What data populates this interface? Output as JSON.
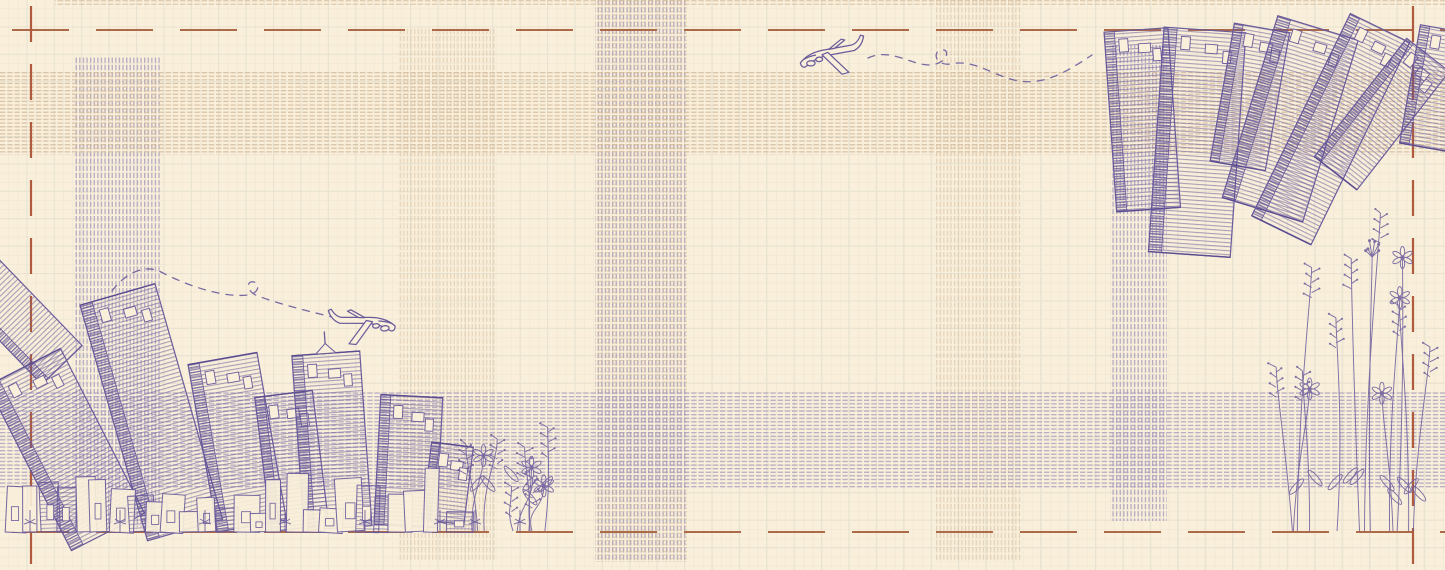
{
  "scene": {
    "title": "blueprint-plaid-city-wallpaper",
    "description": "Hand-sketched purple-ink city skylines and wildflowers on cream graph paper with woven plaid hatch bands, terracotta dashed register lines and airplane doodles with dashed looping flight trails.",
    "canvas": {
      "width": 1445,
      "height": 570
    },
    "palette": {
      "paper": "#f9efda",
      "subgrid": "#f2e9d7",
      "grid": "#e7e2d1",
      "tan_stripe": "#d6bd9e",
      "purple_stripe": "#a79bbd",
      "ink": "#6a5b9b",
      "ink_dense": "#5a4c90",
      "border_h": "#ac6a48",
      "border_v": "#b15b3e"
    },
    "grid": {
      "cell": 27.4,
      "subcell": 9.14
    }
  },
  "borders": {
    "horizontal_dashed": [
      {
        "y": 30,
        "x1": 0,
        "x2": 1445,
        "dash": "57 27",
        "width": 2
      },
      {
        "y": 532,
        "x1": 0,
        "x2": 1445,
        "dash": "57 27",
        "width": 2
      }
    ],
    "vertical_dashed": [
      {
        "x": 31,
        "y1": 0,
        "y2": 570,
        "dash": "36 22",
        "width": 2.2
      },
      {
        "x": 1413,
        "y1": 0,
        "y2": 570,
        "dash": "36 22",
        "width": 2.2
      }
    ]
  },
  "bands": {
    "vertical": [
      {
        "x": 75,
        "w": 85,
        "y1": 57,
        "y2": 527,
        "kind": "purple",
        "opacity": 0.8
      },
      {
        "x": 398,
        "w": 99,
        "y1": 28,
        "y2": 560,
        "kind": "tan",
        "opacity": 0.5
      },
      {
        "x": 595,
        "w": 92,
        "y1": 0,
        "y2": 562,
        "kind": "purple",
        "opacity": 0.85,
        "extra": "tan"
      },
      {
        "x": 935,
        "w": 87,
        "y1": 0,
        "y2": 562,
        "kind": "tan",
        "opacity": 0.55
      },
      {
        "x": 1110,
        "w": 57,
        "y1": 45,
        "y2": 521,
        "kind": "purple",
        "opacity": 0.8
      }
    ],
    "horizontal": [
      {
        "y": 0,
        "h": 7,
        "x1": 55,
        "x2": 1445,
        "kind": "tan",
        "opacity": 0.7
      },
      {
        "y": 70,
        "h": 85,
        "x1": 0,
        "x2": 1445,
        "kind": "tan",
        "opacity": 0.85
      },
      {
        "y": 392,
        "h": 96,
        "x1": 0,
        "x2": 1445,
        "kind": "purple",
        "opacity": 0.78
      }
    ]
  },
  "cities": {
    "bottom_left": {
      "name": "upright skyline fanning outward, base on lower dashed line",
      "ground_y": 532,
      "buildings": [
        {
          "cx": 62,
          "base": 365,
          "w": 56,
          "h": 135,
          "tilt": -44,
          "fragment": true
        },
        {
          "cx": 108,
          "base": 532,
          "w": 82,
          "h": 185,
          "tilt": -27
        },
        {
          "cx": 185,
          "base": 530,
          "w": 78,
          "h": 245,
          "tilt": -16
        },
        {
          "cx": 252,
          "base": 526,
          "w": 70,
          "h": 170,
          "tilt": -10
        },
        {
          "cx": 300,
          "base": 528,
          "w": 58,
          "h": 135,
          "tilt": -7
        },
        {
          "cx": 338,
          "base": 528,
          "w": 68,
          "h": 175,
          "tilt": -4,
          "spire": true
        },
        {
          "cx": 405,
          "base": 526,
          "w": 62,
          "h": 130,
          "tilt": 3
        },
        {
          "cx": 443,
          "base": 522,
          "w": 42,
          "h": 78,
          "tilt": 7
        }
      ],
      "base_strip": {
        "x1": 2,
        "x2": 458,
        "seed": 11,
        "count": 26
      },
      "trees_x": [
        30,
        120,
        205,
        285,
        365,
        440,
        475,
        520
      ]
    },
    "top_right": {
      "name": "inverted skyline hanging from upper dashed line",
      "ceiling_y": 30,
      "buildings": [
        {
          "cx": 1136,
          "top": 30,
          "w": 64,
          "h": 180,
          "tilt": -4
        },
        {
          "cx": 1205,
          "top": 30,
          "w": 82,
          "h": 225,
          "tilt": 4
        },
        {
          "cx": 1262,
          "top": 28,
          "w": 56,
          "h": 140,
          "tilt": 10
        },
        {
          "cx": 1318,
          "top": 28,
          "w": 84,
          "h": 190,
          "tilt": 17
        },
        {
          "cx": 1380,
          "top": 28,
          "w": 66,
          "h": 225,
          "tilt": 26
        },
        {
          "cx": 1428,
          "top": 55,
          "w": 54,
          "h": 150,
          "tilt": 38
        },
        {
          "cx": 1450,
          "top": 30,
          "w": 60,
          "h": 120,
          "tilt": 10
        }
      ]
    }
  },
  "planes": [
    {
      "name": "jet flying left, upper right area",
      "x": 797,
      "y": 37,
      "facing": "left",
      "rotate": -3,
      "trail": "M868,58 C893,46 916,70 936,64 C948,61 950,48 941,50 C932,52 936,66 950,64 C974,59 990,74 1014,80 C1043,87 1066,72 1092,55"
    },
    {
      "name": "jet flying right, above bottom-left skyline",
      "x": 394,
      "y": 300,
      "facing": "right",
      "rotate": -7,
      "trail": "M112,291 C126,272 146,264 161,272 C186,285 222,298 248,295 C258,294 261,284 254,282 C246,280 246,292 258,296 C282,305 312,312 332,317"
    }
  ],
  "flowers": [
    {
      "name": "tall wildflower border, right edge",
      "x0": 1292,
      "base_y": 531,
      "w": 122,
      "h": 325,
      "n": 13,
      "seed": 7
    },
    {
      "name": "grass and flower tuft, right of skyline",
      "x0": 428,
      "base_y": 531,
      "w": 118,
      "h": 105,
      "n": 9,
      "seed": 3
    }
  ]
}
